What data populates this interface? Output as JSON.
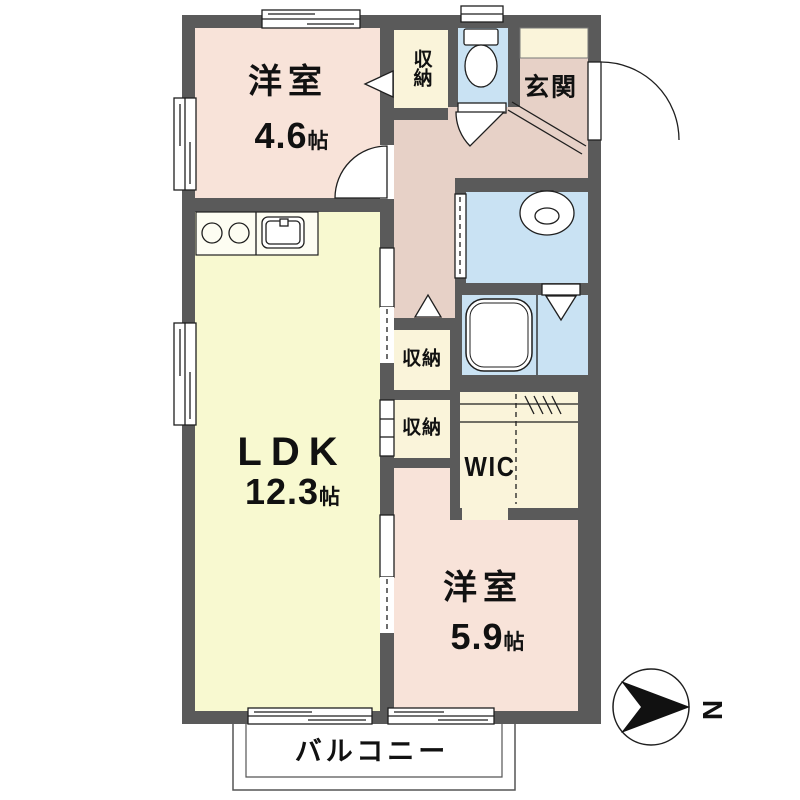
{
  "plan": {
    "rooms": {
      "bedroom_a": {
        "label": "洋室",
        "size": "4.6",
        "unit": "帖"
      },
      "ldk": {
        "label": "LDK",
        "size": "12.3",
        "unit": "帖"
      },
      "bedroom_b": {
        "label": "洋室",
        "size": "5.9",
        "unit": "帖"
      },
      "storage_top": {
        "label": "収納"
      },
      "storage_mid_upper": {
        "label": "収納"
      },
      "storage_mid_lower": {
        "label": "収納"
      },
      "wic": {
        "label": "WIC"
      },
      "entrance": {
        "label": "玄関"
      },
      "balcony": {
        "label": "バルコニー"
      }
    },
    "compass": {
      "north_label": "N"
    },
    "colors": {
      "wall": "#5a5a5a",
      "western_room": "#f8e3d9",
      "hallway": "#e7d1c7",
      "ldk": "#f8f9d0",
      "storage": "#faf4da",
      "wet_area": "#c9e2f3",
      "line": "#1f1f1f"
    }
  }
}
